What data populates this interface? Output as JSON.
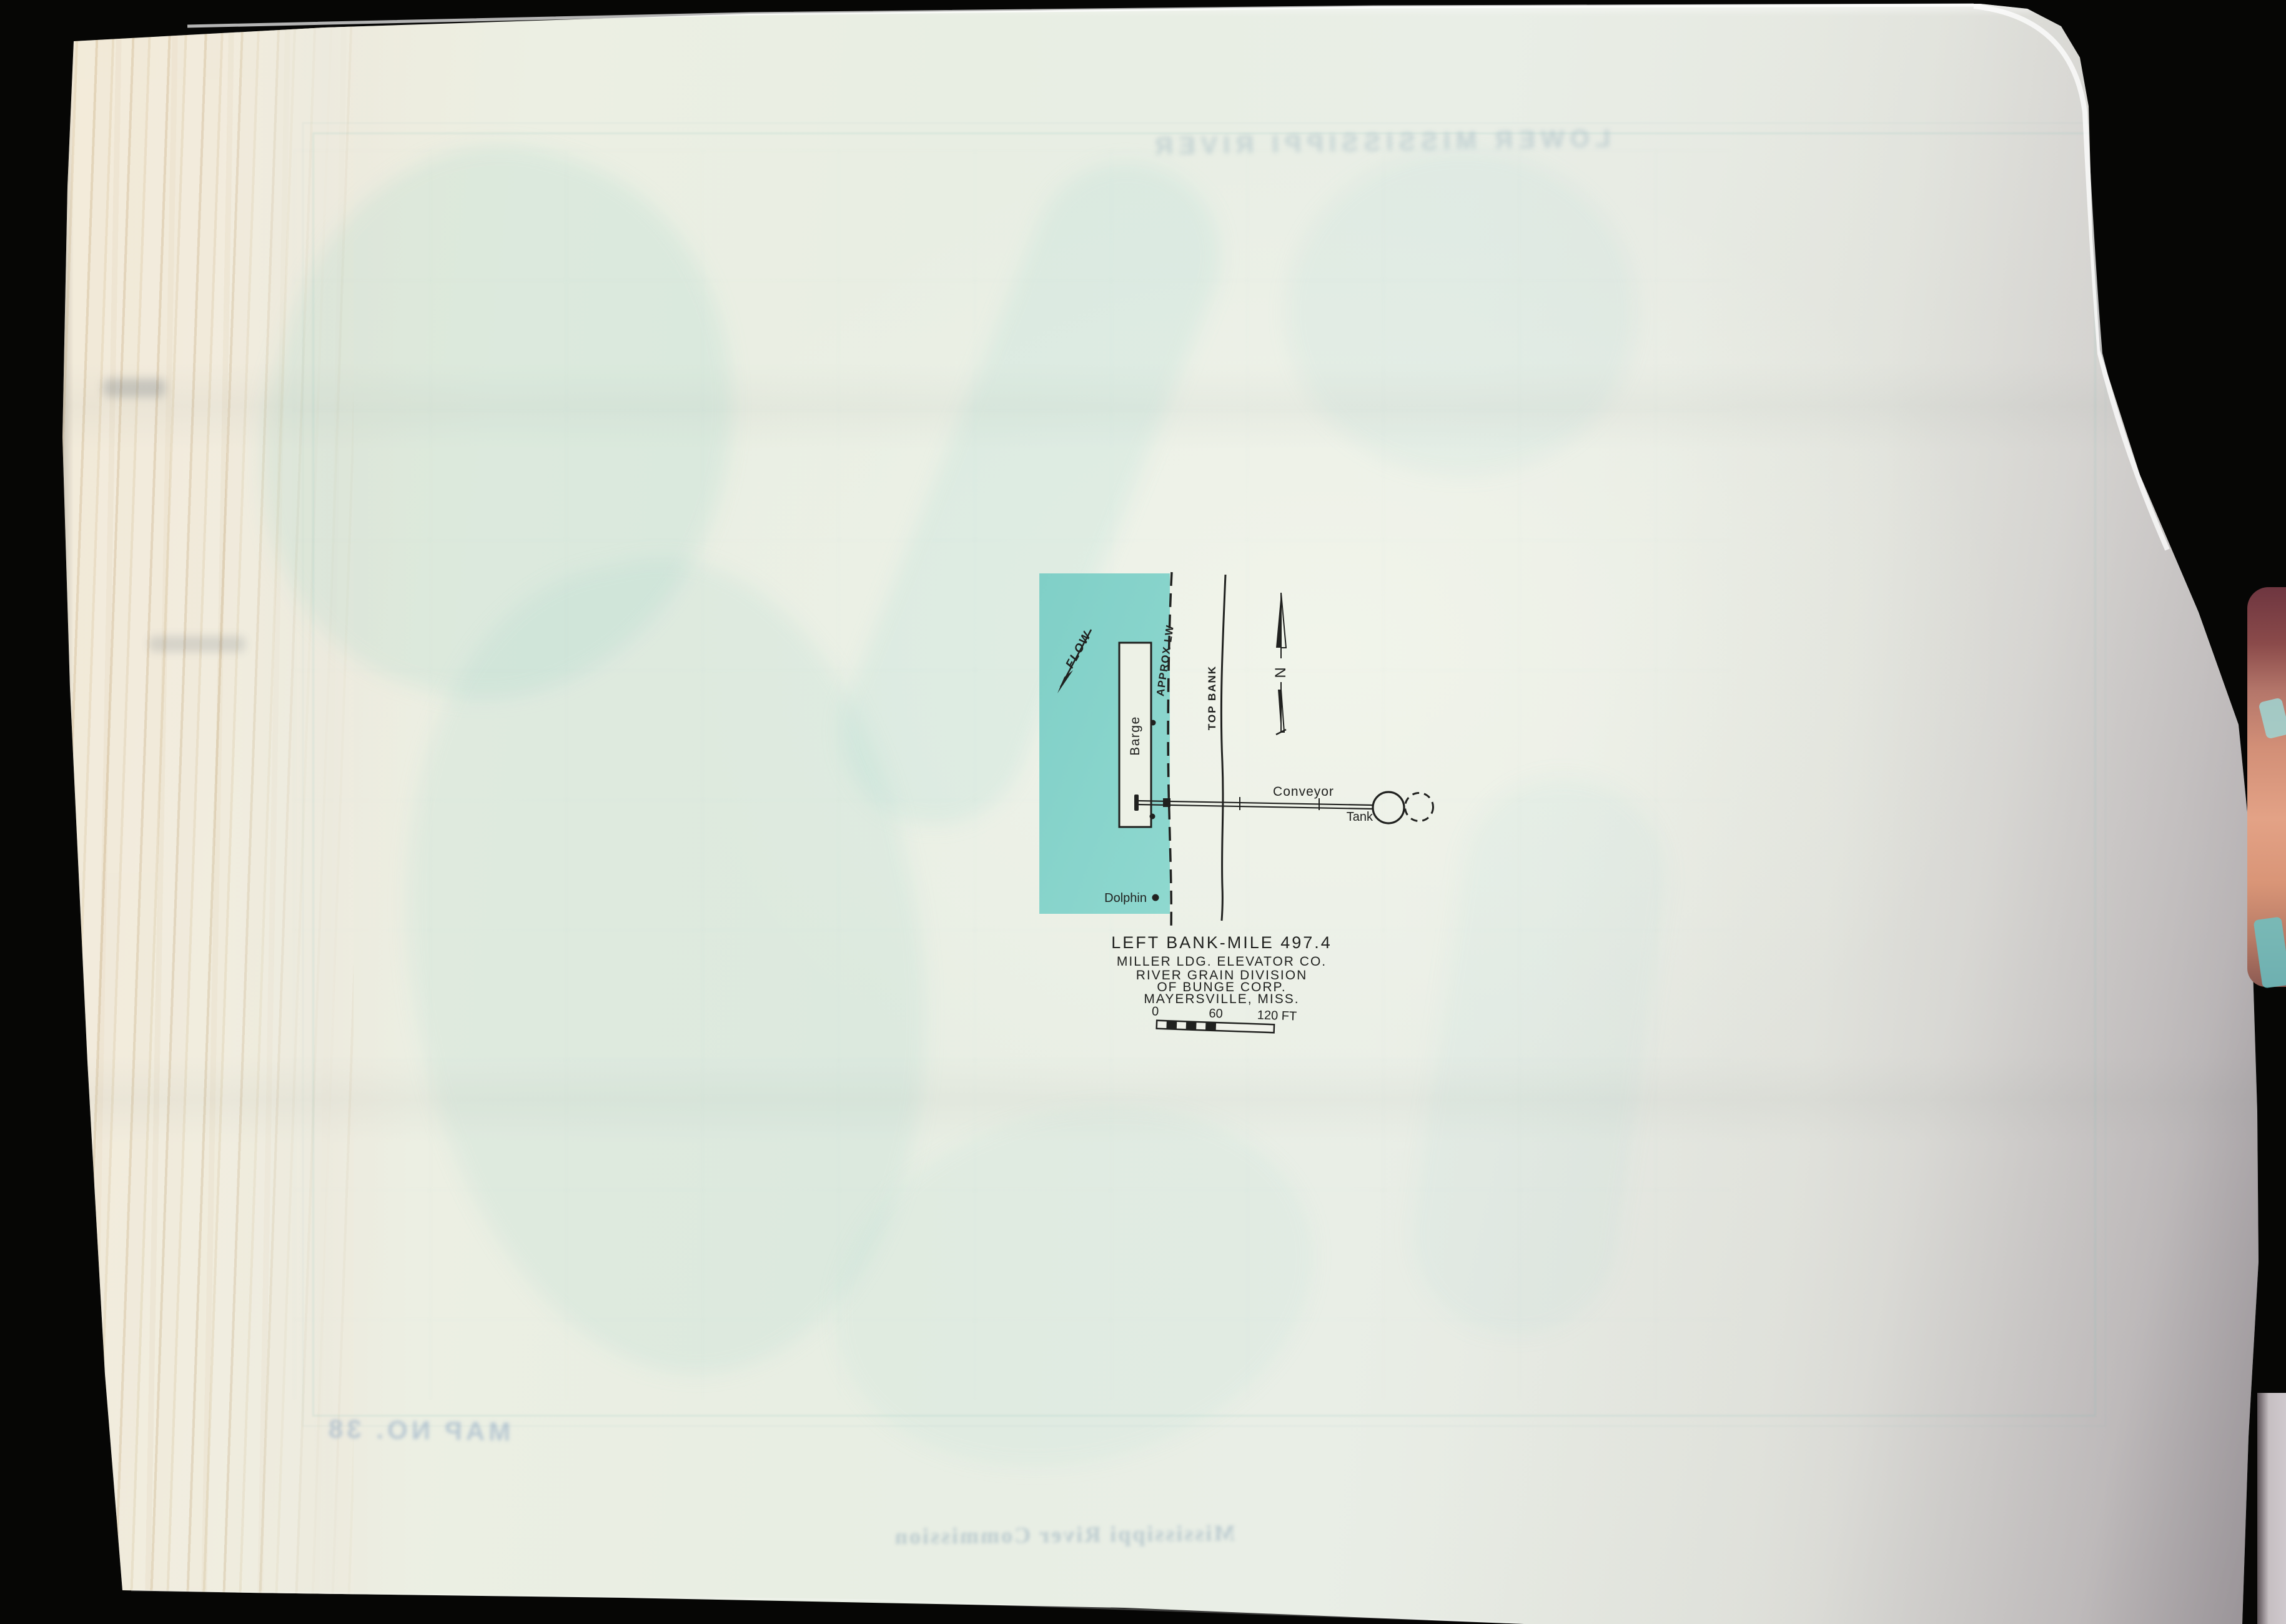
{
  "photo": {
    "background_color": "#060605",
    "page_color": "#e9eee3",
    "page_cream_left": "#f1e7d3",
    "page_shadow_gray": "#bfb9bc",
    "water_color": "#86d3cb",
    "ink_color": "#20211f",
    "finger_color": "#d28f77"
  },
  "diagram": {
    "water_flow_label": "FLOW",
    "approx_lw_label": "APPROX LW",
    "top_bank_label": "TOP BANK",
    "barge_label": "Barge",
    "north_label": "N",
    "conveyor_label": "Conveyor",
    "tank_label": "Tank",
    "dolphin_label": "Dolphin",
    "title": "LEFT BANK-MILE 497.4",
    "subtitle_lines": [
      "MILLER LDG. ELEVATOR CO.",
      "RIVER GRAIN DIVISION",
      "OF BUNGE CORP.",
      "MAYERSVILLE, MISS."
    ],
    "scale_tick_0": "0",
    "scale_tick_60": "60",
    "scale_tick_120": "120 FT"
  },
  "bleed_through": {
    "top_header_mirrored": "LOWER MISSISSIPPI RIVER",
    "map_number_mirrored": "MAP NO. 38",
    "bottom_caption_mirrored": "Mississippi River Commission"
  }
}
